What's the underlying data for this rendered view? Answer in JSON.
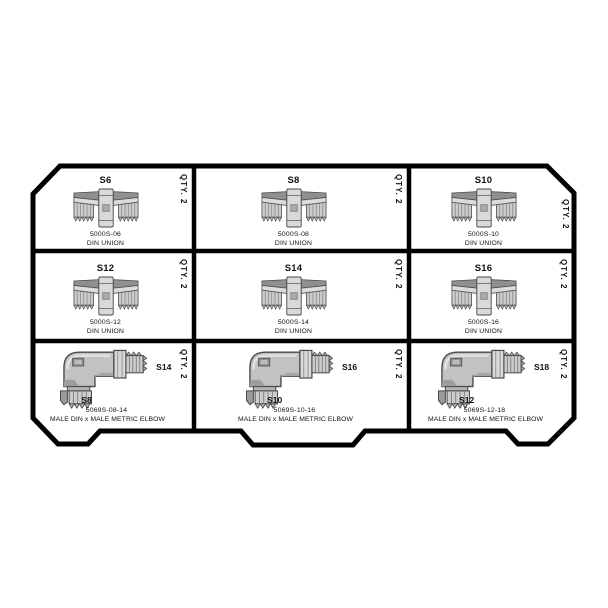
{
  "diagram_name": "fitting-tray-layout",
  "colors": {
    "line": "#000000",
    "text": "#111111",
    "metal_light": "#d9d9d9",
    "metal_mid": "#c6c6c6",
    "metal_dark": "#8f8f8f",
    "metal_stroke": "#4a4a4a",
    "background": "#ffffff"
  },
  "cells": [
    {
      "type": "din_union",
      "illustration": "din-union-fitting",
      "size_label": "S6",
      "part_number": "5000S-06",
      "description": "DIN UNION",
      "quantity": "QTY. 2"
    },
    {
      "type": "din_union",
      "illustration": "din-union-fitting",
      "size_label": "S8",
      "part_number": "5000S-08",
      "description": "DIN UNION",
      "quantity": "QTY. 2"
    },
    {
      "type": "din_union",
      "illustration": "din-union-fitting",
      "size_label": "S10",
      "part_number": "5000S-10",
      "description": "DIN UNION",
      "quantity": "QTY. 2"
    },
    {
      "type": "din_union",
      "illustration": "din-union-fitting",
      "size_label": "S12",
      "part_number": "5000S-12",
      "description": "DIN UNION",
      "quantity": "QTY. 2"
    },
    {
      "type": "din_union",
      "illustration": "din-union-fitting",
      "size_label": "S14",
      "part_number": "5000S-14",
      "description": "DIN UNION",
      "quantity": "QTY. 2"
    },
    {
      "type": "din_union",
      "illustration": "din-union-fitting",
      "size_label": "S16",
      "part_number": "5000S-16",
      "description": "DIN UNION",
      "quantity": "QTY. 2"
    },
    {
      "type": "elbow",
      "illustration": "elbow-fitting",
      "din_size_label": "S8",
      "metric_size_label": "S14",
      "part_number": "5069S-08-14",
      "description": "MALE DIN x MALE METRIC ELBOW",
      "quantity": "QTY. 2"
    },
    {
      "type": "elbow",
      "illustration": "elbow-fitting",
      "din_size_label": "S10",
      "metric_size_label": "S16",
      "part_number": "5069S-10-16",
      "description": "MALE DIN x MALE METRIC ELBOW",
      "quantity": "QTY. 2"
    },
    {
      "type": "elbow",
      "illustration": "elbow-fitting",
      "din_size_label": "S12",
      "metric_size_label": "S18",
      "part_number": "5069S-12-18",
      "description": "MALE DIN x MALE METRIC ELBOW",
      "quantity": "QTY. 2"
    }
  ]
}
